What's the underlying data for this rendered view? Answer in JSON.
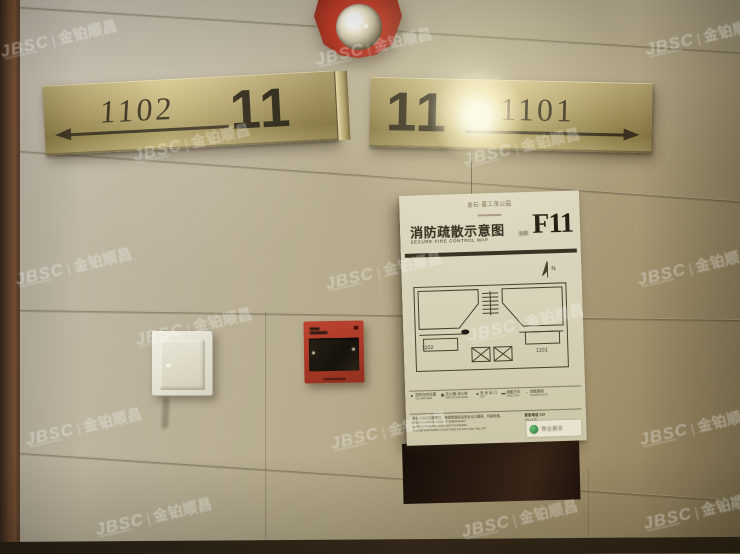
{
  "watermark": {
    "brand": "JBSC",
    "divider": "|",
    "company": "金铂顺昌"
  },
  "signs": {
    "left": {
      "unit": "1102",
      "floor": "11",
      "arrow_direction": "left"
    },
    "right": {
      "floor": "11",
      "unit": "1101",
      "arrow_direction": "right"
    }
  },
  "evacuation_map": {
    "building_name": "金石·嘉工茂公园",
    "title_zh": "消防疏散示意图",
    "title_en": "SECURE FIRE CONTROL MAP",
    "floor_label_prefix": "当前",
    "floor_code": "F11",
    "plan": {
      "north_label": "N",
      "unit_left": "1102",
      "unit_right": "1101"
    },
    "legend": [
      {
        "glyph": "►",
        "zh": "您所在的位置",
        "en": "YOU ARE HERE"
      },
      {
        "glyph": "▣",
        "zh": "灭火器·消火栓",
        "en": "FIRE EXTINGUISHER"
      },
      {
        "glyph": "◄",
        "zh": "安 全 出 口",
        "en": "EXIT"
      },
      {
        "glyph": "▬",
        "zh": "疏散方向",
        "en": "DIRECTION"
      },
      {
        "glyph": "←",
        "zh": "疏散路线",
        "en": "ESCAPE ROUTE"
      }
    ],
    "notice": {
      "zh": "发生火灾时请按警铃，按疏散路线由安全出口撤离，勿乘电梯。",
      "en_lines": [
        "PRESS ALARM IN CASE OF EMERGENCY",
        "ALARM SOUNDING AND LIGHT FLASHING",
        "PLEASE EVACUATE TO EXIT AND DO NOT USE THE LIFT"
      ],
      "phone_zh": "紧急电话 119",
      "phone_en": "CALL 119"
    },
    "property_logo_text": "物业服务"
  },
  "colors": {
    "brass": "#c9b97e",
    "sign_text": "#2c2616",
    "alarm_red": "#b23b28",
    "wall": "#b3a98f",
    "map_paper": "#d8d3bb",
    "panel_brown": "#2a1c12",
    "logo_green": "#3e8a4a"
  }
}
